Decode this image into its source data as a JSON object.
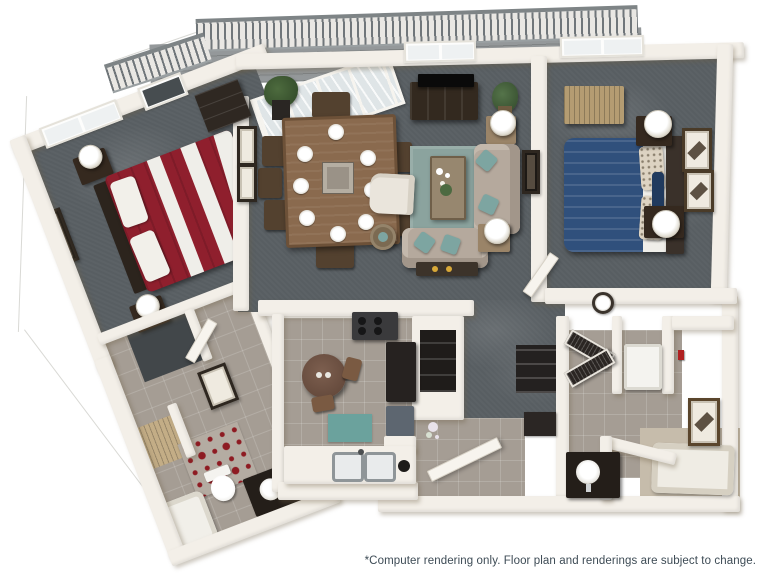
{
  "footer": {
    "disclaimer": "*Computer rendering only. Floor plan and renderings are subject to change."
  },
  "palette": {
    "wall": "#f3efe8",
    "wallShade": "#d9d2c6",
    "carpet": "#585e62",
    "carpetDark": "#42474a",
    "tile": "#a59d94",
    "tileLight": "#b4aca2",
    "balconyFloor": "#94989a",
    "railing": "#70767a",
    "bedRed": "#8f1f2d",
    "bedBlue": "#30507c",
    "sheetWhite": "#efeee9",
    "woodDark": "#33291f",
    "woodMedium": "#8a6a4e",
    "woodLight": "#b49c72",
    "sofa": "#b5a99d",
    "rugTeal": "#8ba39e",
    "pillowTeal": "#7da5a1",
    "matTeal": "#6ba29d",
    "rugRedAccent": "#8e1b22",
    "text": "#3d4b55"
  },
  "floorplan": {
    "view": "3d-isometric-apartment-rendering",
    "balcony": [
      "slat-railing",
      "plank-floor",
      "sliding-glass-door",
      "potted-plant"
    ],
    "bedroom_1": [
      "red-white-striped-bed",
      "dark-headboard",
      "nightstand-with-lamp-x2",
      "wall-art",
      "window",
      "carpet"
    ],
    "dining_area": [
      "rectangular-wood-table",
      "eight-place-settings",
      "eight-chairs",
      "centerpiece",
      "two-wall-frames",
      "potted-plant",
      "dark-sideboard"
    ],
    "living_room": [
      "tv-console",
      "flat-tv",
      "teal-area-rug",
      "beige-sofa-x2",
      "teal-accent-pillows",
      "white-armchair",
      "coffee-table",
      "end-table-with-lamp-x2",
      "round-side-table",
      "console-table",
      "potted-plant",
      "wall-art",
      "window"
    ],
    "bedroom_2": [
      "blue-bed",
      "white-sheet-fold",
      "patterned-pillows",
      "dark-headboard",
      "nightstand-with-lamp-x2",
      "light-wood-dresser",
      "two-wall-frames",
      "window"
    ],
    "kitchen": [
      "round-breakfast-table",
      "two-chairs",
      "teal-floor-mat",
      "double-sink-counter",
      "stove",
      "refrigerator",
      "dishwasher",
      "tile-floor"
    ],
    "bathroom_1": [
      "red-diamond-rug",
      "toilet",
      "dark-vanity-with-round-sink",
      "bathtub",
      "framed-mirror",
      "tile-floor"
    ],
    "bathroom_2": [
      "garden-tub",
      "dark-vanity-with-round-sink",
      "framed-art",
      "tile-floor",
      "half-wall"
    ],
    "hall": [
      "wall-clock",
      "louvered-laundry-closet",
      "washer",
      "linen-closet",
      "entry-door",
      "walk-in-closet"
    ]
  }
}
